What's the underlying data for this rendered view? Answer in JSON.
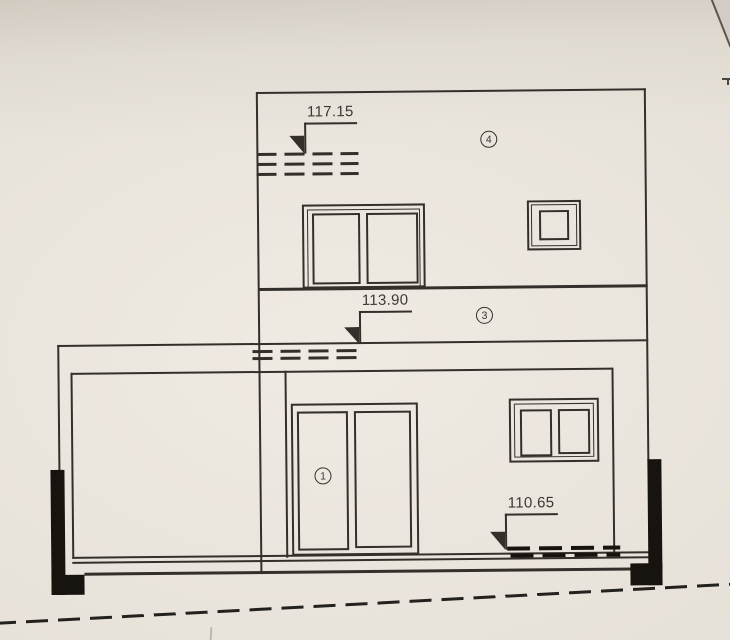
{
  "document": {
    "type_note": "photographed architectural elevation drawing",
    "colors": {
      "paper": "#e8e3da",
      "ink": "#33302b",
      "black_fill": "#17140f",
      "backdrop": "#d2ccc4"
    }
  },
  "drawing": {
    "levels": {
      "upper": {
        "value": "117.15"
      },
      "middle": {
        "value": "113.90"
      },
      "ground": {
        "value": "110.65"
      }
    },
    "callouts": {
      "four": "4",
      "three": "3",
      "one": "1"
    }
  }
}
